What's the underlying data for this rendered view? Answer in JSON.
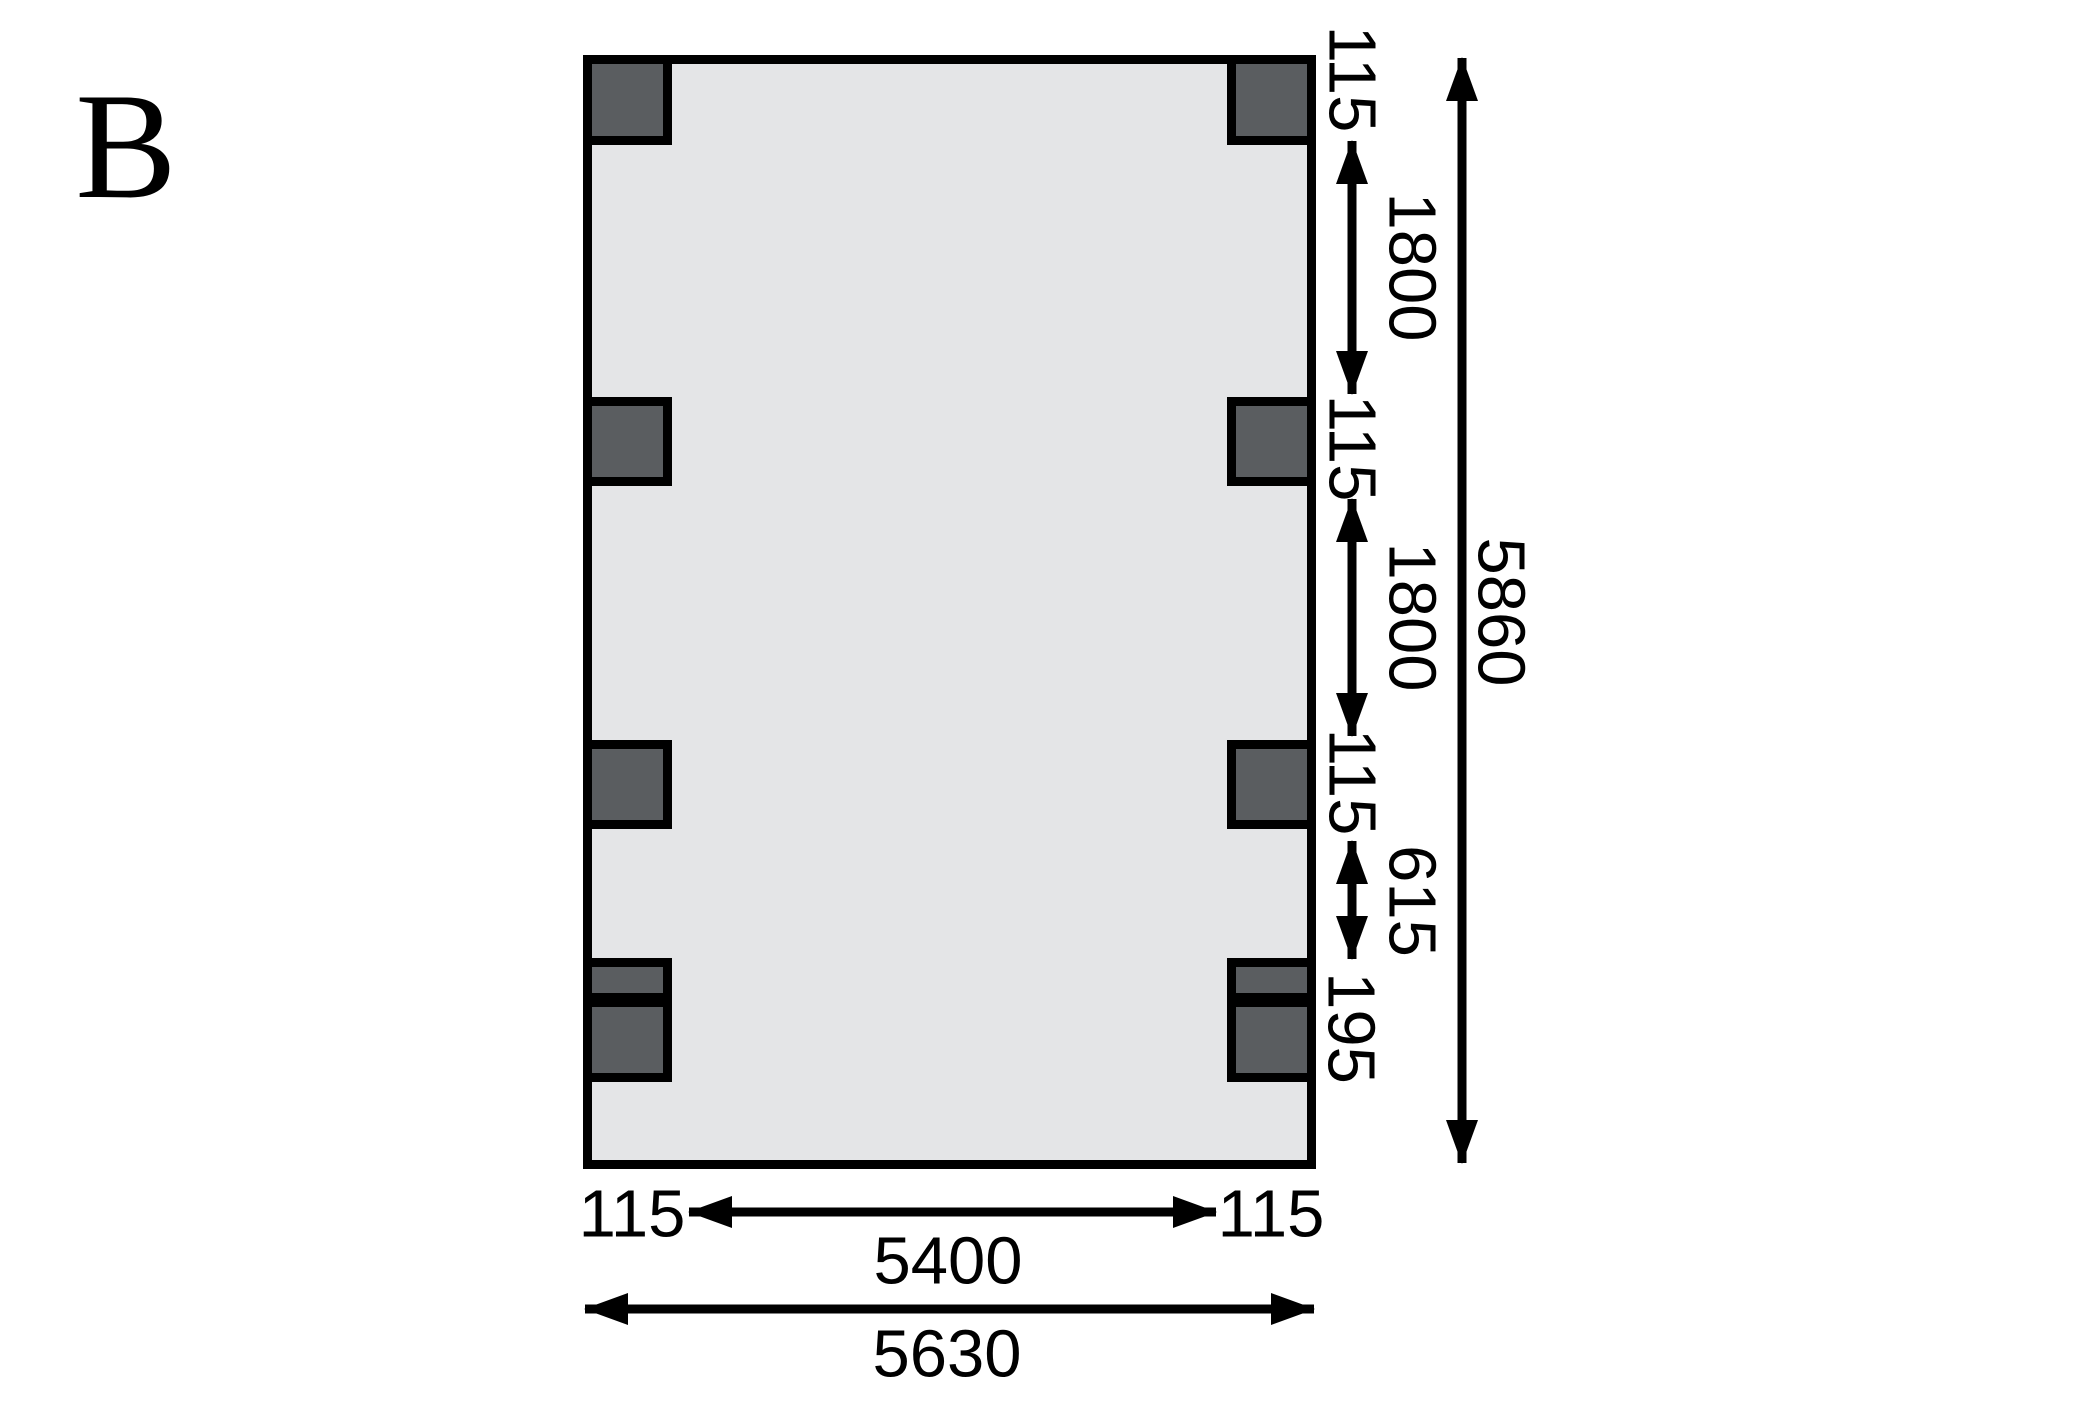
{
  "figure_label": "B",
  "colors": {
    "background": "#ffffff",
    "floor_fill": "#e4e5e7",
    "post_fill": "#5a5d60",
    "line": "#000000"
  },
  "dims": {
    "right_chain": [
      {
        "id": "post-width-top",
        "label": "115"
      },
      {
        "id": "bay-upper",
        "label": "1800"
      },
      {
        "id": "post-width-mid",
        "label": "115"
      },
      {
        "id": "bay-middle",
        "label": "1800"
      },
      {
        "id": "post-width-lower",
        "label": "115"
      },
      {
        "id": "bay-lower",
        "label": "615"
      },
      {
        "id": "anchor-depth",
        "label": "195"
      }
    ],
    "right_overall": "5860",
    "bottom_left_post": "115",
    "bottom_span": "5400",
    "bottom_right_post": "115",
    "bottom_overall": "5630"
  }
}
